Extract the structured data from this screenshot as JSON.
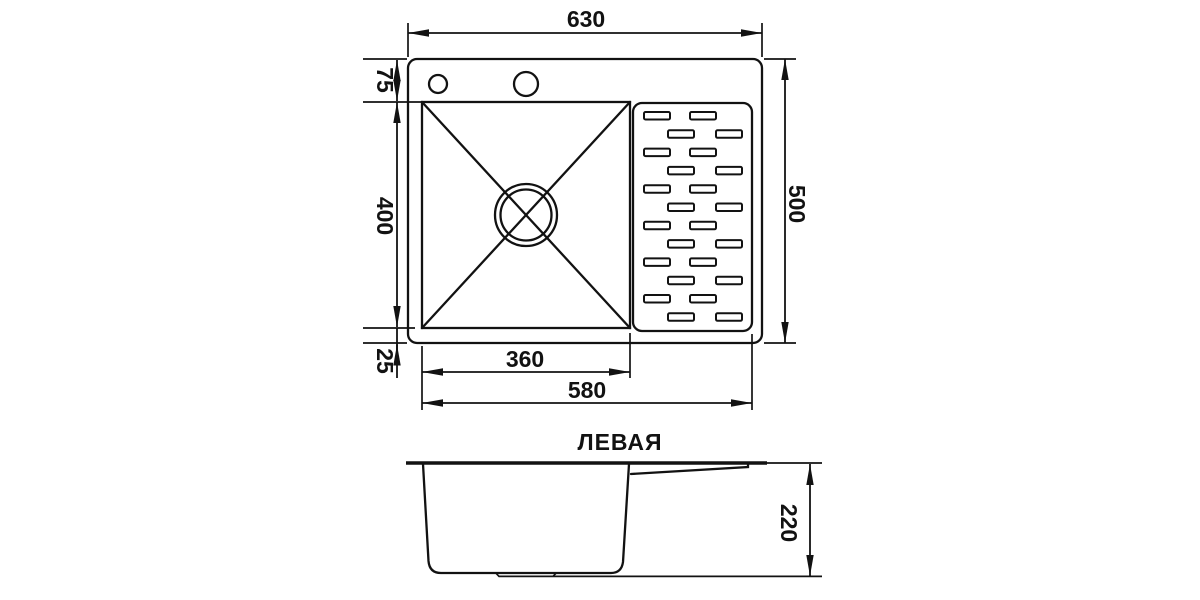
{
  "title": "ЛЕВАЯ",
  "dimensions": {
    "top_view": {
      "overall_width": "630",
      "overall_depth": "500",
      "rim_to_bowl_top": "75",
      "bowl_front_to_back": "400",
      "bowl_to_bottom_edge": "25",
      "bowl_width": "360",
      "bowl_plus_drainboard": "580"
    },
    "side_view": {
      "height": "220"
    }
  },
  "colors": {
    "line": "#121212",
    "background": "#ffffff"
  }
}
